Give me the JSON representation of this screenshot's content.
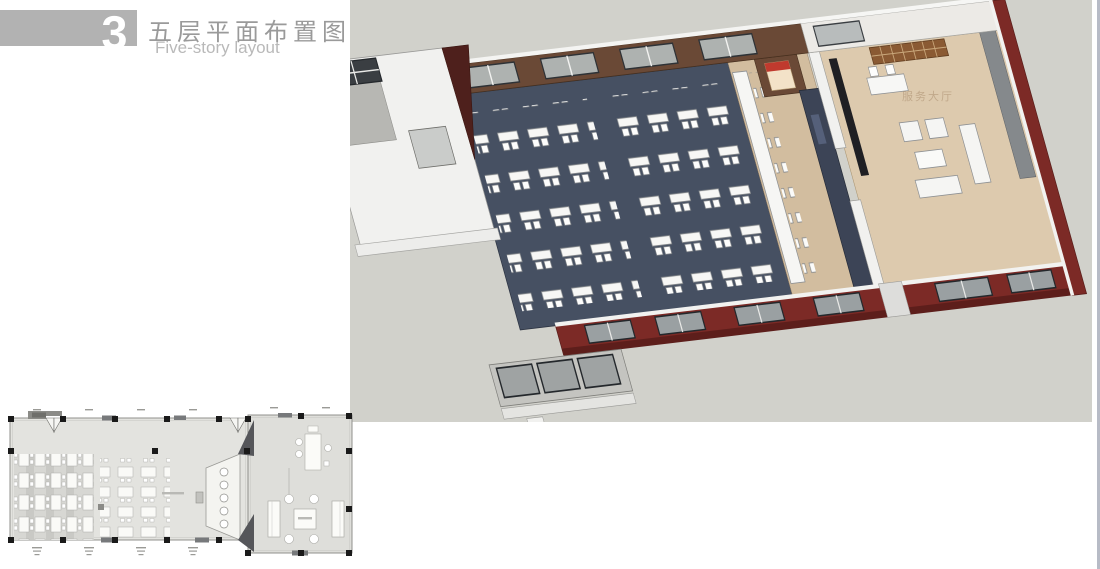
{
  "header": {
    "number": "3",
    "title_zh": "五层平面布置图",
    "title_en": "Five-story layout"
  },
  "render3d": {
    "watermark": "服务大厅",
    "palette": {
      "background": "#d1d1cb",
      "carpet": "#465062",
      "wood_wall": "#6a4936",
      "exterior_wall": "#7c2a26",
      "stage_floor": "#d2bd9f",
      "lounge_floor": "#ddcaae",
      "furniture_white": "#f5f5f3",
      "screen_wall": "#3c4456",
      "bookshelf": "#8a5a33",
      "poster_red": "#c03a2e"
    }
  },
  "floorplan": {
    "palette": {
      "floor": "#e3e3df",
      "right_room_floor": "#dededa",
      "column": "#1a1a1a",
      "wall": "#90908c",
      "furniture_stroke": "#adada9",
      "accent_dark": "#55565a"
    }
  }
}
